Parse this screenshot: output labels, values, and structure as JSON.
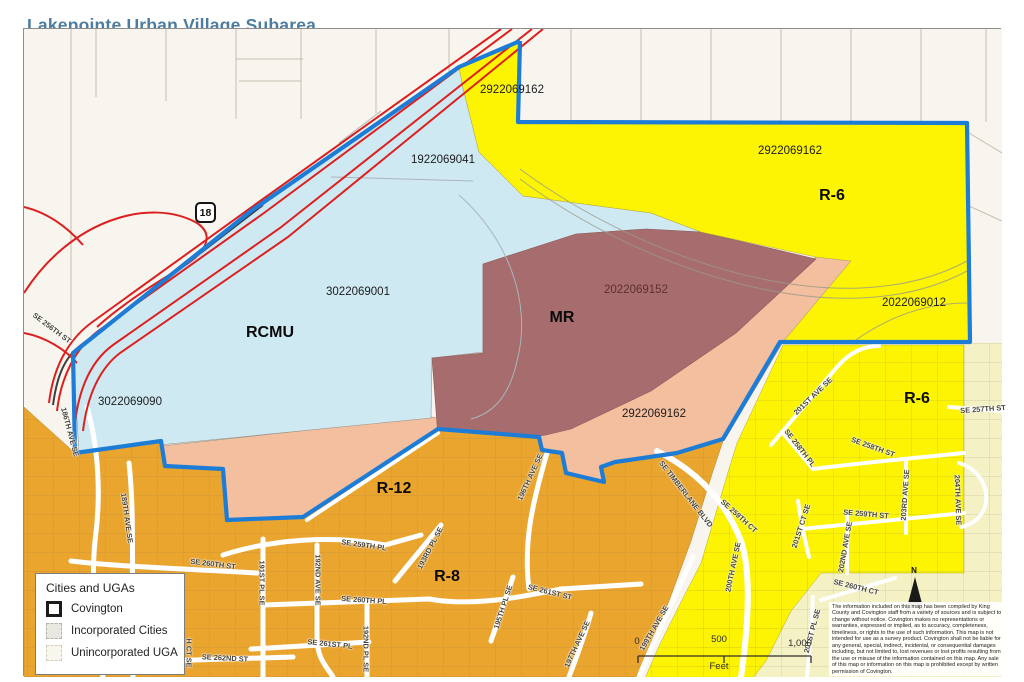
{
  "title": "Lakepointe Urban Village Subarea",
  "highway_shield": "18",
  "north_label": "N",
  "colors": {
    "offwhite": "#f8f5ee",
    "lightblue": "#cfe9f2",
    "yellow": "#fcf402",
    "pale_yellow": "#f4f1c4",
    "maroon": "#a76c6d",
    "salmon": "#f4bf9f",
    "orange": "#eaa52f",
    "boundary_blue": "#1d7cd6",
    "highway_red": "#dc1f1f",
    "title_blue": "#4c7da0"
  },
  "legend": {
    "title": "Cities and UGAs",
    "items": [
      {
        "label": "Covington"
      },
      {
        "label": "Incorporated Cities"
      },
      {
        "label": "Unincorporated UGA"
      }
    ]
  },
  "scale_bar": {
    "start": "0",
    "mid": "500",
    "end": "1,000",
    "unit": "Feet"
  },
  "disclaimer": "The information included on this map has been compiled by King County and Covington staff from a variety of sources and is subject to change without notice. Covington makes no representations or warranties, expressed or implied, as to accuracy, completeness, timeliness, or rights to the use of such information. This map is not intended for use as a survey product. Covington shall not be liable for any general, special, indirect, incidental, or consequential damages including, but not limited to, lost revenues or lost profits resulting from the use or misuse of the information contained on this map. Any sale of this map or information on this map is prohibited except by written permission of Covington.",
  "map": {
    "zones": [
      {
        "code": "RCMU",
        "x": 270,
        "y": 333
      },
      {
        "code": "MR",
        "x": 562,
        "y": 318
      },
      {
        "code": "R-6",
        "x": 832,
        "y": 196
      },
      {
        "code": "R-6",
        "x": 917,
        "y": 399
      },
      {
        "code": "R-12",
        "x": 394,
        "y": 489
      },
      {
        "code": "R-8",
        "x": 447,
        "y": 577
      }
    ],
    "parcels": [
      {
        "id": "2922069162",
        "x": 512,
        "y": 90
      },
      {
        "id": "2922069162",
        "x": 790,
        "y": 151
      },
      {
        "id": "1922069041",
        "x": 443,
        "y": 160
      },
      {
        "id": "3022069001",
        "x": 358,
        "y": 292
      },
      {
        "id": "2022069152",
        "x": 636,
        "y": 290,
        "dark": true
      },
      {
        "id": "2022069012",
        "x": 914,
        "y": 303
      },
      {
        "id": "2922069162",
        "x": 654,
        "y": 414
      },
      {
        "id": "3022069090",
        "x": 130,
        "y": 402
      }
    ],
    "streets": [
      {
        "name": "SE 256TH ST",
        "x": 52,
        "y": 328,
        "rot": 37
      },
      {
        "name": "186TH AVE SE",
        "x": 70,
        "y": 432,
        "rot": 75
      },
      {
        "name": "189TH AVE SE",
        "x": 127,
        "y": 518,
        "rot": 82
      },
      {
        "name": "SE 260TH ST",
        "x": 213,
        "y": 564,
        "rot": 7
      },
      {
        "name": "191ST PL SE",
        "x": 262,
        "y": 583,
        "rot": 90
      },
      {
        "name": "H CT SE",
        "x": 189,
        "y": 653,
        "rot": 90
      },
      {
        "name": "SE 262ND ST",
        "x": 225,
        "y": 658,
        "rot": 3
      },
      {
        "name": "192ND AVE SE",
        "x": 318,
        "y": 580,
        "rot": 90
      },
      {
        "name": "SE 259TH PL",
        "x": 364,
        "y": 545,
        "rot": 8
      },
      {
        "name": "SE 260TH PL",
        "x": 364,
        "y": 600,
        "rot": 4
      },
      {
        "name": "SE 261ST PL",
        "x": 330,
        "y": 644,
        "rot": 6
      },
      {
        "name": "192ND PL SE",
        "x": 366,
        "y": 649,
        "rot": 90
      },
      {
        "name": "193RD PL SE",
        "x": 430,
        "y": 548,
        "rot": -62
      },
      {
        "name": "195TH PL SE",
        "x": 503,
        "y": 607,
        "rot": -72
      },
      {
        "name": "SE 261ST ST",
        "x": 550,
        "y": 592,
        "rot": 14
      },
      {
        "name": "196TH AVE SE",
        "x": 530,
        "y": 477,
        "rot": -65
      },
      {
        "name": "197TH AVE SE",
        "x": 577,
        "y": 644,
        "rot": -65
      },
      {
        "name": "199TH AVE SE",
        "x": 654,
        "y": 628,
        "rot": -60
      },
      {
        "name": "SE TIMBERLANE BLVD",
        "x": 686,
        "y": 494,
        "rot": 52
      },
      {
        "name": "200TH AVE SE",
        "x": 733,
        "y": 567,
        "rot": -78
      },
      {
        "name": "SE 259TH CT",
        "x": 739,
        "y": 516,
        "rot": 42
      },
      {
        "name": "201ST AVE SE",
        "x": 813,
        "y": 396,
        "rot": -44
      },
      {
        "name": "SE 258TH PL",
        "x": 800,
        "y": 448,
        "rot": 52
      },
      {
        "name": "SE 258TH ST",
        "x": 873,
        "y": 447,
        "rot": 20
      },
      {
        "name": "SE 257TH ST",
        "x": 983,
        "y": 409,
        "rot": -4
      },
      {
        "name": "203RD AVE SE",
        "x": 905,
        "y": 495,
        "rot": -86
      },
      {
        "name": "204TH AVE SE",
        "x": 958,
        "y": 500,
        "rot": 88
      },
      {
        "name": "SE 259TH ST",
        "x": 866,
        "y": 514,
        "rot": 5
      },
      {
        "name": "201ST CT SE",
        "x": 801,
        "y": 526,
        "rot": -72
      },
      {
        "name": "202ND AVE SE",
        "x": 845,
        "y": 547,
        "rot": -80
      },
      {
        "name": "SE 260TH CT",
        "x": 856,
        "y": 587,
        "rot": 14
      },
      {
        "name": "201ST PL SE",
        "x": 812,
        "y": 631,
        "rot": -75
      }
    ]
  }
}
